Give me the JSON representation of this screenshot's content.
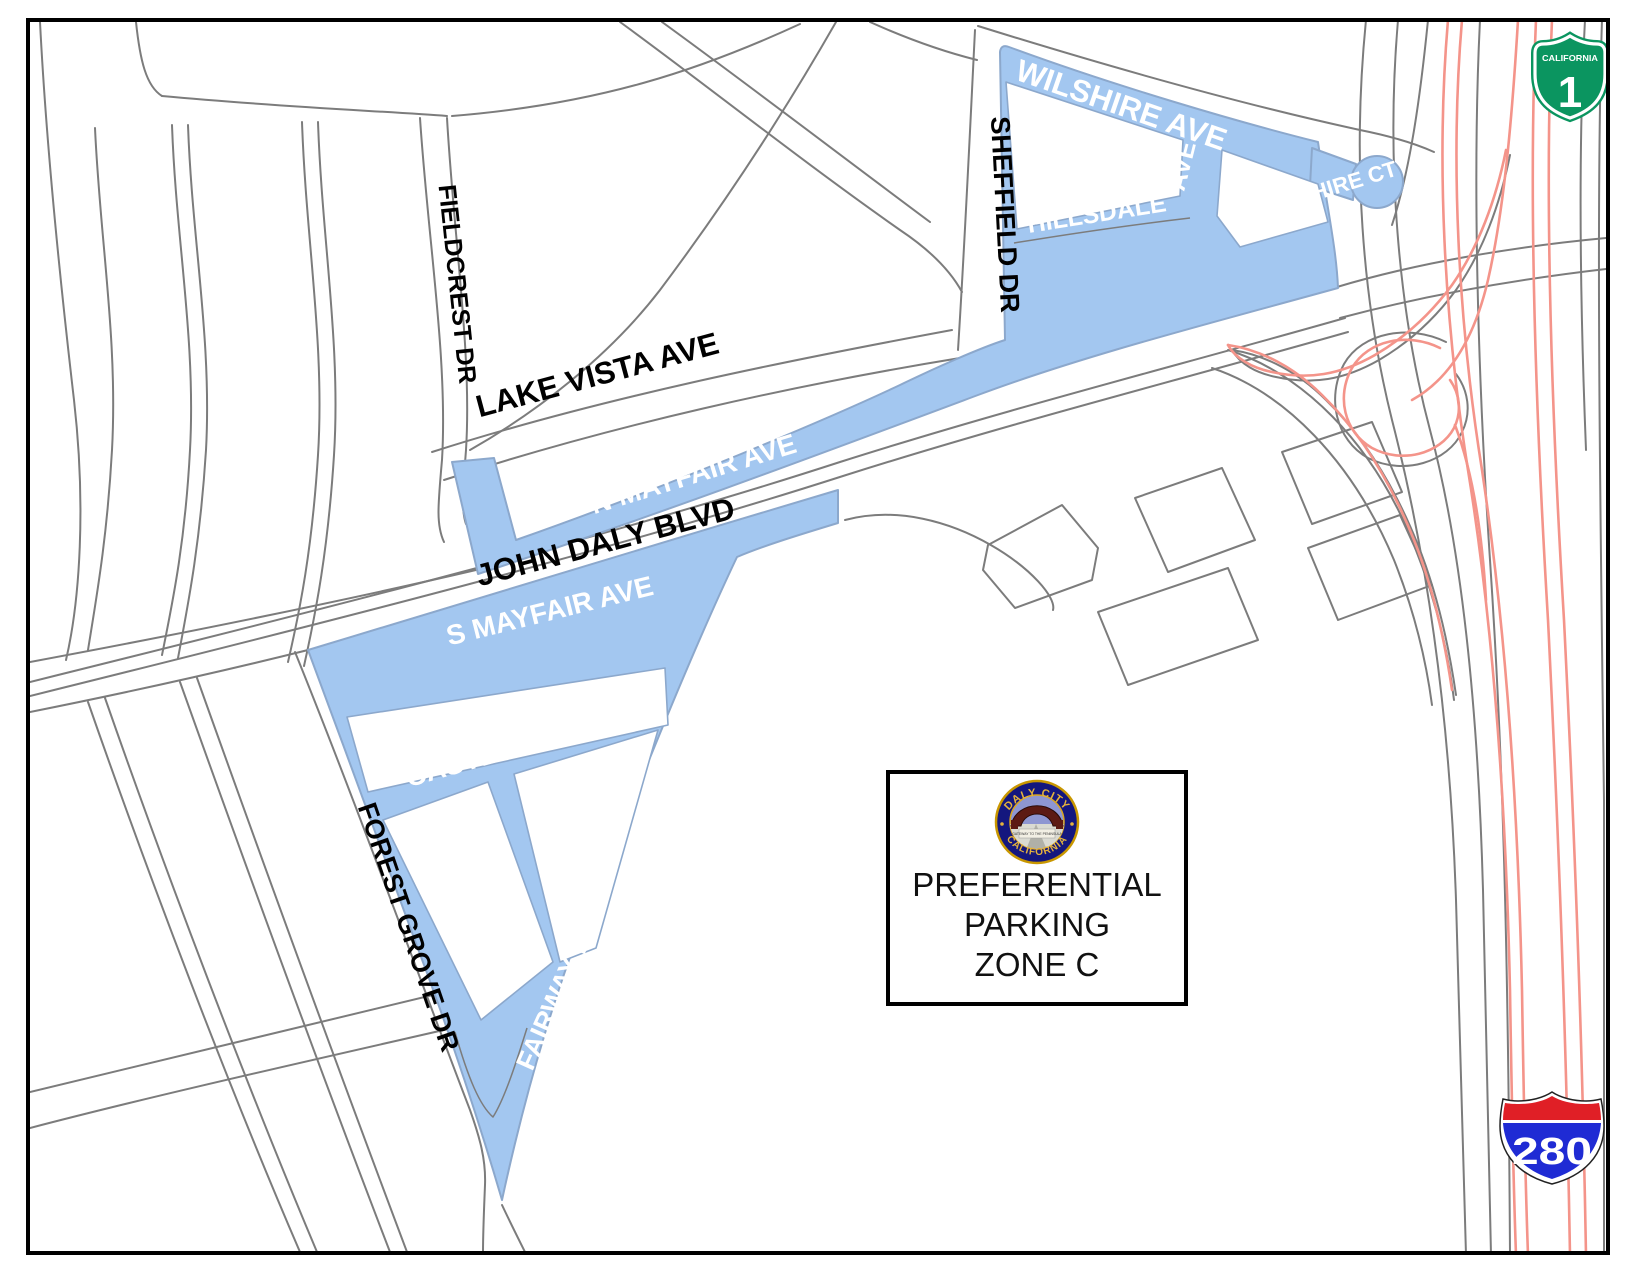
{
  "streets": {
    "wilshire_ave": "WILSHIRE AVE",
    "hillsdale": "HILLSDALE",
    "hillsdale_ave_suffix": "AVE",
    "wilshire_ct": "WILSHIRE CT",
    "sheffield_dr": "SHEFFIELD DR",
    "fieldcrest_dr": "FIELDCREST DR",
    "lake_vista_ave": "LAKE VISTA AVE",
    "n_mayfair_ave": "N MAYFAIR AVE",
    "john_daly_blvd": "JOHN DALY BLVD",
    "s_mayfair_ave": "S MAYFAIR AVE",
    "castlemont_ave": "CASTLEMONT AVE",
    "forest_grove_dr": "FOREST GROVE DR",
    "fairway_dr": "FAIRWAY DR"
  },
  "shields": {
    "ca1": {
      "caption": "CALIFORNIA",
      "route": "1"
    },
    "i280": {
      "route": "280"
    }
  },
  "legend": {
    "line1": "PREFERENTIAL",
    "line2": "PARKING",
    "line3": "ZONE C",
    "seal": {
      "top": "DALY CITY",
      "bottom": "CALIFORNIA",
      "banner": "GATEWAY TO THE PENINSULA"
    }
  },
  "colors": {
    "zone_fill": "#A3C7F0",
    "zone_stroke": "#8CA8CC",
    "road": "#7C7C7C",
    "freeway_accent": "#F4948A",
    "shield_green": "#0B9560",
    "interstate_red": "#E01F26",
    "interstate_blue": "#1F2BD4",
    "border": "#000000"
  }
}
